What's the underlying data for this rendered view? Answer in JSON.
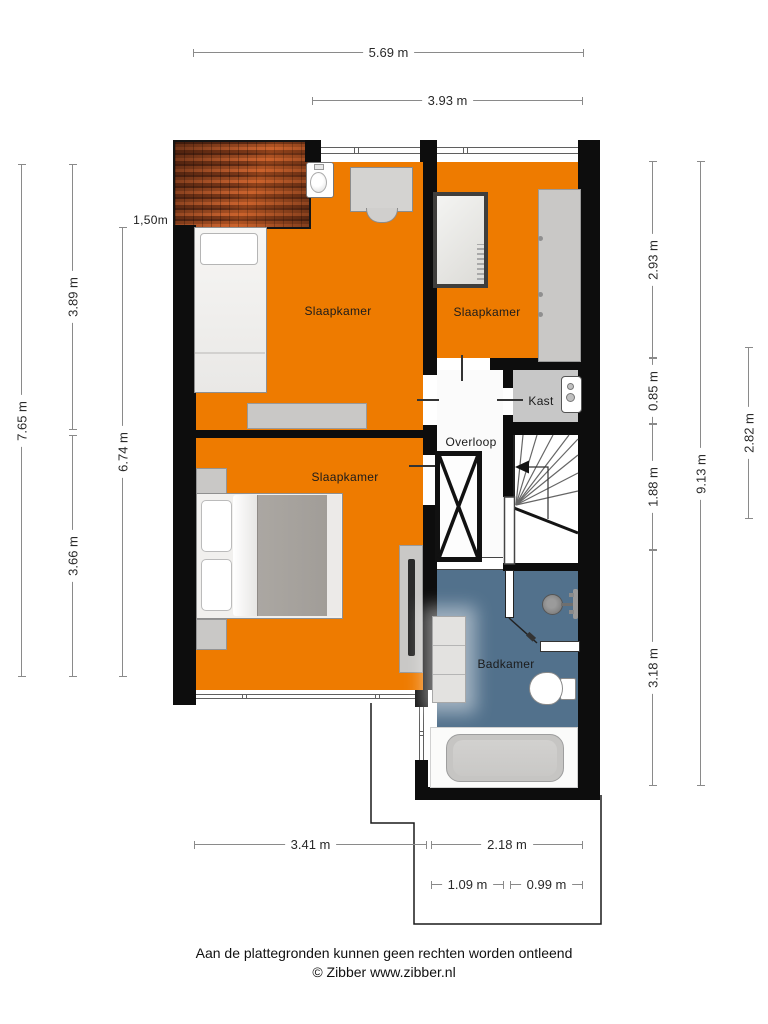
{
  "plan": {
    "rooms": {
      "bedroom_top_left": {
        "label": "Slaapkamer"
      },
      "bedroom_top_right": {
        "label": "Slaapkamer"
      },
      "bedroom_bottom_left": {
        "label": "Slaapkamer"
      },
      "closet": {
        "label": "Kast"
      },
      "landing": {
        "label": "Overloop"
      },
      "bathroom": {
        "label": "Badkamer"
      }
    },
    "annotation_height": "1,50m",
    "colors": {
      "room_orange": "#EE7B00",
      "bathroom_blue": "#52718C",
      "closet_gray": "#C7C7C7",
      "landing_white": "#FBFBFB",
      "wall_black": "#0D0D0D",
      "roof_brown": "#8A4520"
    }
  },
  "dimensions": {
    "top": [
      {
        "label": "5.69 m"
      },
      {
        "label": "3.93 m"
      }
    ],
    "left": [
      {
        "label": "7.65 m"
      },
      {
        "label": "3.89 m"
      },
      {
        "label": "3.66 m"
      },
      {
        "label": "6.74 m"
      }
    ],
    "right": [
      {
        "label": "2.93 m"
      },
      {
        "label": "0.85 m"
      },
      {
        "label": "1.88 m"
      },
      {
        "label": "3.18 m"
      },
      {
        "label": "9.13 m"
      },
      {
        "label": "2.82 m"
      }
    ],
    "bottom": [
      {
        "label": "3.41 m"
      },
      {
        "label": "2.18 m"
      },
      {
        "label": "1.09 m"
      },
      {
        "label": "0.99 m"
      }
    ]
  },
  "footer": {
    "disclaimer": "Aan de plattegronden kunnen geen rechten worden ontleend",
    "copyright": "© Zibber www.zibber.nl"
  }
}
